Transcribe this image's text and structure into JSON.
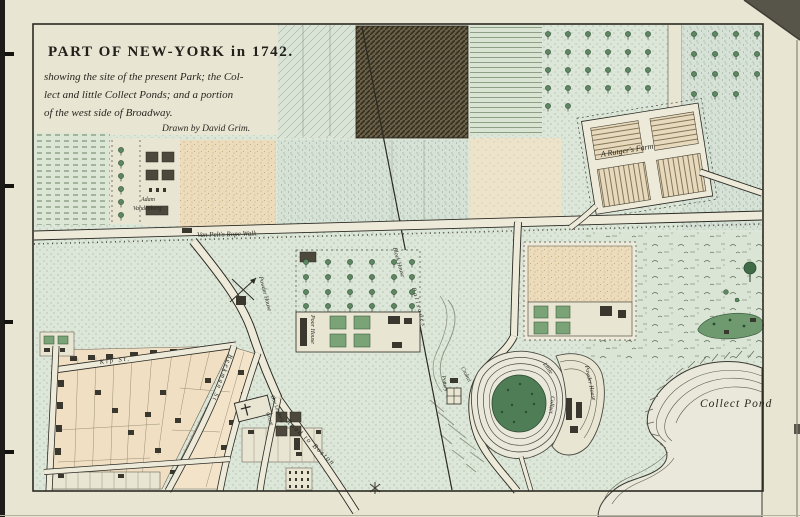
{
  "title_block": {
    "title": "PART OF NEW-YORK in 1742.",
    "subtitle1": "showing the site of the present Park; the Col-",
    "subtitle2": "lect and little Collect Ponds; and a portion",
    "subtitle3": "of the west side of Broadway.",
    "credit": "Drawn by David Grim."
  },
  "labels": {
    "adam1": "Adam",
    "adam2": "Vandenberg",
    "rope_walk": "Van Pelt's  Rope Walk",
    "rutgers_farm": "A Rutger's Farm",
    "collect_pond": "Collect Pond",
    "little1": "Little",
    "little2": "Collect",
    "powder_house_island": "Powder House",
    "powder_house_west": "Powder House",
    "block_house": "Block House",
    "palisades": "Palisades",
    "poor_house": "Poor House",
    "pottery": "Pottery",
    "crolius": "Crolius",
    "kip_st": "Kip St.",
    "beekman_st": "Beekman St",
    "road_to_boston": "Road to Boston",
    "leisler1": "Gov Leisler's",
    "leisler2": "Grave"
  },
  "colors": {
    "paper": "#e9e5d3",
    "ink": "#2b2a24",
    "field_green": "#dde7d9",
    "field_tan": "#ecdcbb",
    "dark_field": "#6a5f47",
    "pond": "#e9e8da",
    "island": "#4f7d55",
    "vegetation": "#6f9a6f",
    "block_tan": "#f0dfc2",
    "road": "#edead9"
  }
}
